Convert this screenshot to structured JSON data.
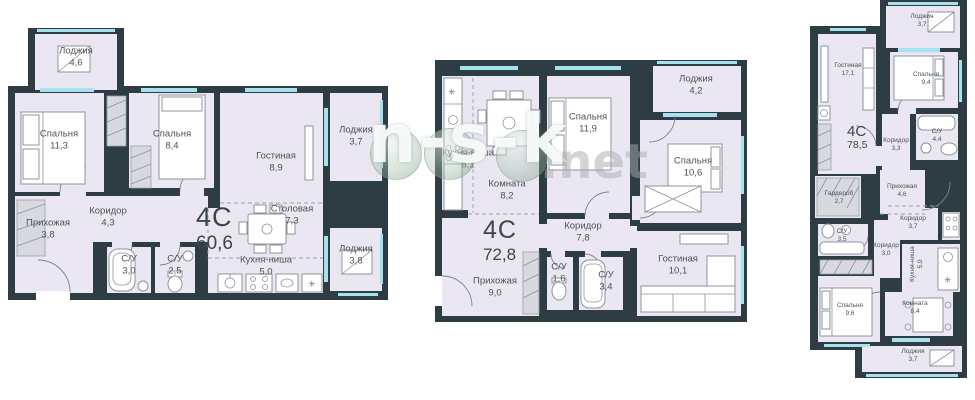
{
  "watermark": {
    "text": "n-s-k",
    "suffix": ".net"
  },
  "colors": {
    "wall": "#2e3c43",
    "room_fill": "#eae6f2",
    "window": "#a6e1f0",
    "label_text": "#4d5257",
    "watermark_bubble": "#9ab8a4"
  },
  "icons": {
    "snowflake": "✳"
  },
  "plans": [
    {
      "name": "plan-left",
      "type_label": "4С",
      "total_area": "60,6",
      "rooms": [
        {
          "name": "Лоджия",
          "area": "4,6"
        },
        {
          "name": "Спальня",
          "area": "11,3"
        },
        {
          "name": "Спальня",
          "area": "8,4"
        },
        {
          "name": "Гостиная",
          "area": "8,9"
        },
        {
          "name": "Лоджия",
          "area": "3,7"
        },
        {
          "name": "Коридор",
          "area": "4,3"
        },
        {
          "name": "Прихожая",
          "area": "3,8"
        },
        {
          "name": "Столовая",
          "area": "7,3"
        },
        {
          "name": "С/У",
          "area": "3,0"
        },
        {
          "name": "С/У",
          "area": "2,5"
        },
        {
          "name": "Кухня-ниша",
          "area": "5,0"
        },
        {
          "name": "Лоджия",
          "area": "3,8"
        }
      ]
    },
    {
      "name": "plan-middle",
      "type_label": "4С",
      "total_area": "72,8",
      "rooms": [
        {
          "name": "Кухня-ниша",
          "area": "8,1"
        },
        {
          "name": "Комната",
          "area": "8,2"
        },
        {
          "name": "Спальня",
          "area": "11,9"
        },
        {
          "name": "Лоджия",
          "area": "4,2"
        },
        {
          "name": "Спальня",
          "area": "10,6"
        },
        {
          "name": "Коридор",
          "area": "7,8"
        },
        {
          "name": "Гостиная",
          "area": "10,1"
        },
        {
          "name": "Прихожая",
          "area": "9,0"
        },
        {
          "name": "С/У",
          "area": "1,6"
        },
        {
          "name": "С/У",
          "area": "3,4"
        }
      ]
    },
    {
      "name": "plan-right",
      "type_label": "4С",
      "total_area": "78,5",
      "rooms": [
        {
          "name": "Лоджия",
          "area": "3,7"
        },
        {
          "name": "Гостиная",
          "area": "17,1"
        },
        {
          "name": "Спальня",
          "area": "9,4"
        },
        {
          "name": "С/У",
          "area": "4,4"
        },
        {
          "name": "Коридор",
          "area": "3,3"
        },
        {
          "name": "Прихожая",
          "area": "4,6"
        },
        {
          "name": "Гардероб",
          "area": "2,7"
        },
        {
          "name": "С/У",
          "area": "3,5"
        },
        {
          "name": "Коридор",
          "area": "3,0"
        },
        {
          "name": "Коридор",
          "area": "3,7"
        },
        {
          "name": "Кухня-ниша",
          "area": "5,0"
        },
        {
          "name": "Комната",
          "area": "8,4"
        },
        {
          "name": "Спальня",
          "area": "9,6"
        },
        {
          "name": "Лоджия",
          "area": "3,7"
        }
      ]
    }
  ]
}
